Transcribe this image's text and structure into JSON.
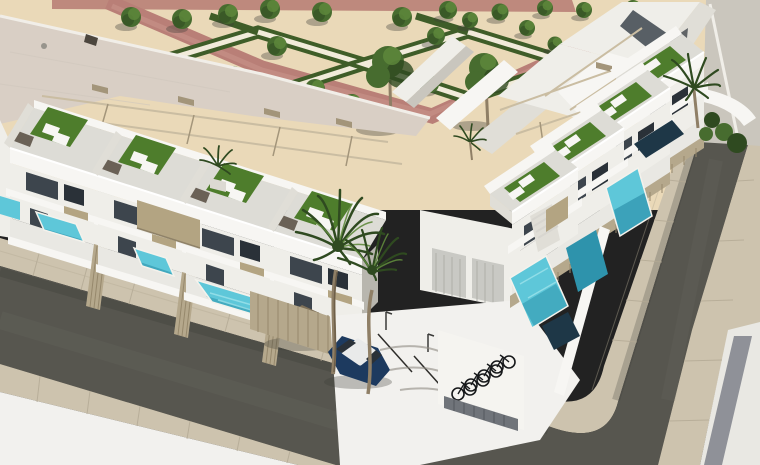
{
  "image": {
    "type": "architectural-3d-render",
    "subject": "Aerial 3D rendering of a modern white residential complex with rooftop solarium terraces, private turquoise pools, a formal landscaped park, palm trees, asphalt streets, parked cars and a bicycle rack",
    "view": "aerial oblique",
    "width_px": 760,
    "height_px": 465
  },
  "palette": {
    "sand": "#ead9b8",
    "parkWhite": "#f1ebda",
    "pinkPath": "#b97f77",
    "pinkPathLight": "#cb958c",
    "hedge": "#3f5d28",
    "tree": "#476c2f",
    "treeLight": "#5f8a3c",
    "treeDark": "#2f4a20",
    "trunkBrown": "#8f7f66",
    "oldRoof": "#d9cfc5",
    "fascia": "#f1eee8",
    "white": "#f7f6f3",
    "wallLight": "#efeee9",
    "wallMid": "#e0ded7",
    "wallShade": "#c9c6be",
    "glass": "#3d454d",
    "glassDark": "#2a3138",
    "floorGray": "#dddcd6",
    "grass": "#4e7d2c",
    "grassLight": "#619334",
    "aqua": "#5ec7d9",
    "aquaLight": "#9ce2ea",
    "poolDeep": "#2e93ac",
    "poolNavy": "#1e3747",
    "roadDark": "#57564f",
    "roadWorn": "#6e6d66",
    "sidewalkTile": "#cdc3ae",
    "tileLine": "#b3a994",
    "pavementWhite": "#f2f1ee",
    "pavementLight": "#e9e8e3",
    "pavementWarm": "#cac6bd",
    "curb": "#f4f2ec",
    "grayStripe": "#8f9198",
    "fence": "#b5a88c",
    "fenceLine": "#96886c",
    "pergola": "#cabda2",
    "pergolaDark": "#a3957a",
    "tanPanel": "#b3a482",
    "wicker": "#6a6156",
    "carBrown": "#5d503f",
    "carBrownLight": "#7e7058",
    "carBlue": "#1d3a5f",
    "carRoof": "#e9eaea",
    "bike": "#17191b",
    "gateGray": "#70747a",
    "shadow": "#3c3b36",
    "parkingLine": "#2e2d2a",
    "stairLine": "#d8d6d0"
  },
  "scene": {
    "park": {
      "name": "formal garden park",
      "ground": "sand",
      "hedge_pattern": "zigzag diamond parterres with white gravel paths",
      "walkway": "terracotta path bordering the park",
      "small_trees": 20,
      "large_trees": 2
    },
    "existing_building": {
      "name": "flat-roof building",
      "roof": "pink-grey flat roof"
    },
    "townhouses": {
      "left_row_units": 4,
      "right_row_units": 4,
      "corner_section": "angular white volumes",
      "roof_features": [
        "solarium terraces",
        "artificial grass",
        "sun loungers",
        "rattan lounge set",
        "pergola frames"
      ],
      "facade_features": [
        "dark glazing",
        "white balconies",
        "tan privacy panels",
        "slatted tan garden fences"
      ]
    },
    "pools": {
      "count": 9,
      "colors": [
        "turquoise",
        "deep teal",
        "navy in shade"
      ]
    },
    "streets": {
      "layout": "L-shaped dark asphalt street wrapping a corner",
      "sidewalks": "beige tiled with curb lines",
      "parking": {
        "stalls": 3,
        "street_lamps": 2
      },
      "cars": [
        {
          "color": "bronze brown",
          "location": "carport behind slatted fence"
        },
        {
          "color": "dark blue with white roof",
          "location": "open parking stall"
        }
      ],
      "bike_rack": {
        "bicycles": 4,
        "gate": "dark grey slatted gate"
      }
    },
    "vegetation": {
      "courtyard_palms": 2,
      "rooftop_palms": 2,
      "street_palm": 1,
      "street_bushes": 4
    }
  }
}
